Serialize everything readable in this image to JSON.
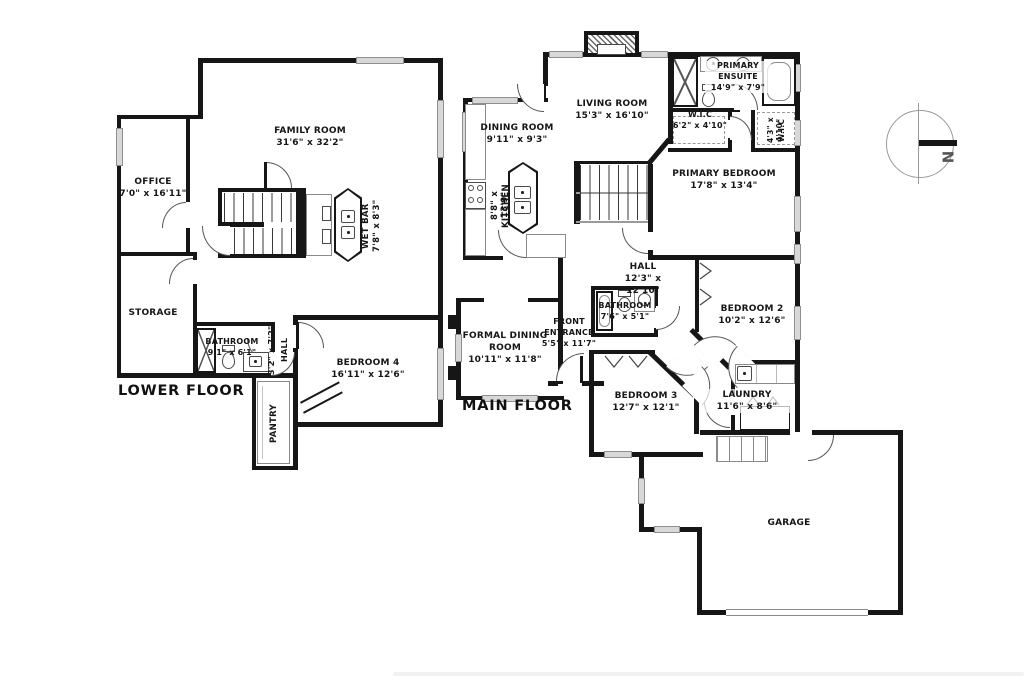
{
  "compass": {
    "north_label": "N"
  },
  "floors": {
    "lower": {
      "title": "LOWER FLOOR",
      "rooms": {
        "family": {
          "name": "FAMILY ROOM",
          "dims": "31'6\" x 32'2\""
        },
        "office": {
          "name": "OFFICE",
          "dims": "7'0\" x 16'11\""
        },
        "storage": {
          "name": "STORAGE",
          "dims": ""
        },
        "bathroom": {
          "name": "BATHROOM",
          "dims": "9'1\" x 6'1\""
        },
        "hall": {
          "name": "HALL",
          "dims": "3'2\" x 7'2\""
        },
        "bedroom4": {
          "name": "BEDROOM 4",
          "dims": "16'11\" x 12'6\""
        },
        "pantry": {
          "name": "PANTRY",
          "dims": ""
        },
        "wetbar": {
          "name": "WET BAR",
          "dims": "7'8\" x 8'3\""
        }
      }
    },
    "main": {
      "title": "MAIN FLOOR",
      "rooms": {
        "living": {
          "name": "LIVING ROOM",
          "dims": "15'3\" x 16'10\""
        },
        "dining": {
          "name": "DINING ROOM",
          "dims": "9'11\" x 9'3\""
        },
        "kitchen": {
          "name": "KITCHEN",
          "dims": "8'8\" x 13'9\""
        },
        "ensuite": {
          "name": "PRIMARY ENSUITE",
          "dims": "14'9\" x 7'9\""
        },
        "wic1": {
          "name": "W.I.C",
          "dims": "6'2\" x 4'10\""
        },
        "wic2": {
          "name": "W.I.C",
          "dims": "4'3\" x 4'10\""
        },
        "primary": {
          "name": "PRIMARY BEDROOM",
          "dims": "17'8\" x 13'4\""
        },
        "hall": {
          "name": "HALL",
          "dims": "12'3\" x 12'10\""
        },
        "bathroom": {
          "name": "BATHROOM",
          "dims": "7'6\" x 5'1\""
        },
        "bedroom2": {
          "name": "BEDROOM 2",
          "dims": "10'2\" x 12'6\""
        },
        "formal": {
          "name": "FORMAL DINING ROOM",
          "dims": "10'11\" x 11'8\""
        },
        "entrance": {
          "name": "FRONT ENTRANCE",
          "dims": "5'5\" x 11'7\""
        },
        "bedroom3": {
          "name": "BEDROOM 3",
          "dims": "12'7\" x 12'1\""
        },
        "laundry": {
          "name": "LAUNDRY",
          "dims": "11'6\" x 8'6\""
        },
        "garage": {
          "name": "GARAGE",
          "dims": ""
        }
      }
    }
  }
}
